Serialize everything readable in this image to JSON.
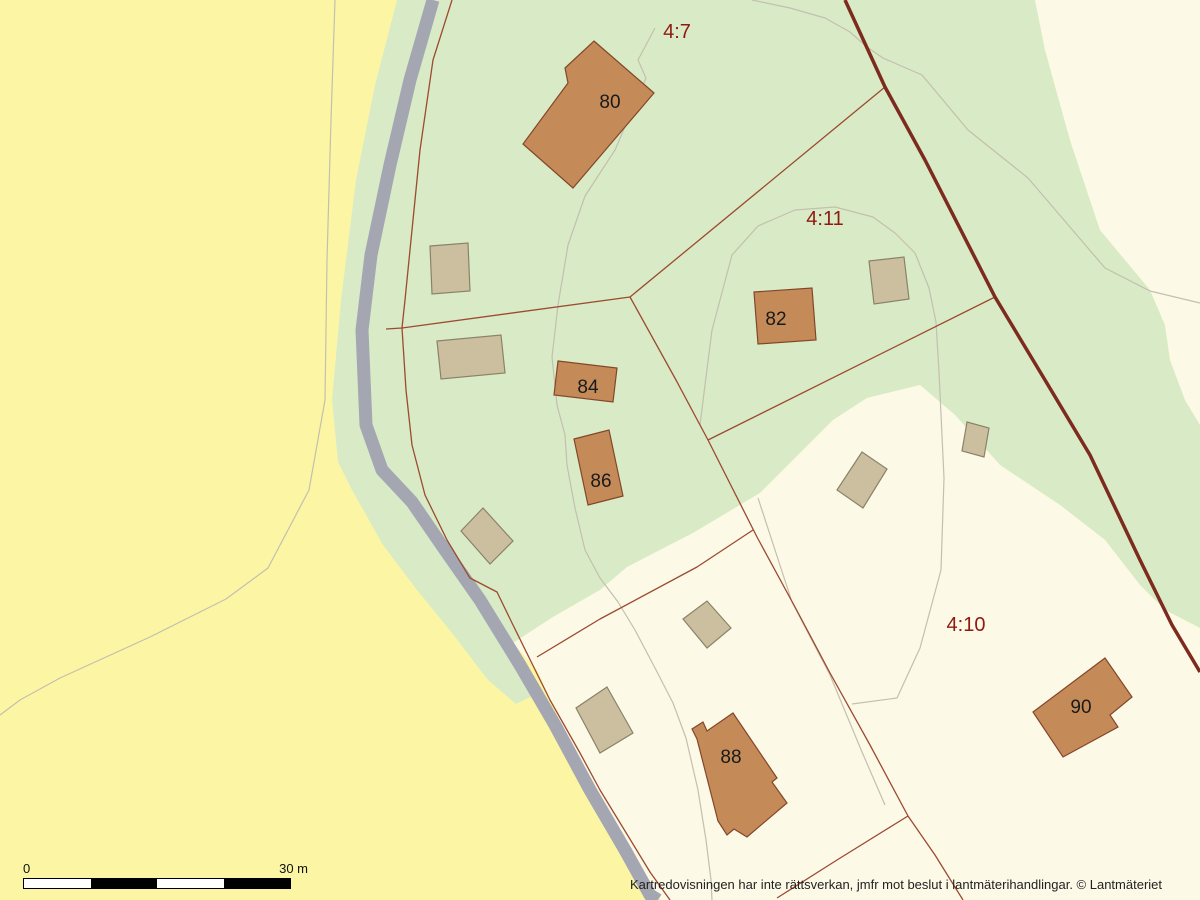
{
  "disclaimer": "Kartredovisningen har inte rättsverkan, jmfr mot beslut i lantmäterihandlingar. © Lantmäteriet",
  "scale_bar": {
    "start_label": "0",
    "end_label": "30 m",
    "segment_colors": [
      "#ffffff",
      "#000000",
      "#ffffff",
      "#000000"
    ]
  },
  "map": {
    "colors": {
      "field": "#FCF6A4",
      "forest": "#D8EBC6",
      "open_land": "#FCF9E7",
      "road": "#A4A6B2",
      "trail": "#C4BFAE",
      "boundary": "#9C4A30",
      "boundary_major": "#7D2B1E",
      "residential_fill": "#C48A58",
      "residential_stroke": "#84462A",
      "outbuilding_fill": "#CBBF9F",
      "outbuilding_stroke": "#8B8268",
      "parcel_label": "#8E1A10",
      "building_label": "#1A1A1A"
    },
    "land_areas": [
      {
        "name": "forest",
        "fill_key": "forest",
        "points": [
          [
            397,
            0
          ],
          [
            375,
            85
          ],
          [
            356,
            180
          ],
          [
            341,
            300
          ],
          [
            332,
            400
          ],
          [
            338,
            462
          ],
          [
            352,
            490
          ],
          [
            383,
            545
          ],
          [
            417,
            590
          ],
          [
            452,
            633
          ],
          [
            488,
            680
          ],
          [
            516,
            704
          ],
          [
            543,
            691
          ],
          [
            513,
            643
          ],
          [
            553,
            617
          ],
          [
            600,
            590
          ],
          [
            627,
            567
          ],
          [
            693,
            533
          ],
          [
            760,
            493
          ],
          [
            833,
            420
          ],
          [
            867,
            398
          ],
          [
            920,
            385
          ],
          [
            955,
            415
          ],
          [
            1000,
            465
          ],
          [
            1060,
            505
          ],
          [
            1105,
            540
          ],
          [
            1140,
            585
          ],
          [
            1165,
            610
          ],
          [
            1200,
            628
          ],
          [
            1200,
            425
          ],
          [
            1185,
            400
          ],
          [
            1170,
            360
          ],
          [
            1165,
            325
          ],
          [
            1150,
            290
          ],
          [
            1100,
            230
          ],
          [
            1070,
            140
          ],
          [
            1045,
            50
          ],
          [
            1035,
            0
          ]
        ]
      },
      {
        "name": "open-land-northeast",
        "fill_key": "open_land",
        "points": [
          [
            1035,
            0
          ],
          [
            1045,
            50
          ],
          [
            1070,
            140
          ],
          [
            1100,
            230
          ],
          [
            1150,
            290
          ],
          [
            1165,
            325
          ],
          [
            1170,
            360
          ],
          [
            1185,
            400
          ],
          [
            1200,
            425
          ],
          [
            1200,
            0
          ]
        ]
      },
      {
        "name": "open-land-south",
        "fill_key": "open_land",
        "points": [
          [
            513,
            643
          ],
          [
            537,
            670
          ],
          [
            562,
            725
          ],
          [
            597,
            790
          ],
          [
            632,
            850
          ],
          [
            657,
            895
          ],
          [
            662,
            900
          ],
          [
            1200,
            900
          ],
          [
            1200,
            628
          ],
          [
            1165,
            610
          ],
          [
            1140,
            585
          ],
          [
            1105,
            540
          ],
          [
            1060,
            505
          ],
          [
            1000,
            465
          ],
          [
            955,
            415
          ],
          [
            920,
            385
          ],
          [
            867,
            398
          ],
          [
            833,
            420
          ],
          [
            760,
            493
          ],
          [
            693,
            533
          ],
          [
            627,
            567
          ],
          [
            600,
            590
          ],
          [
            553,
            617
          ]
        ]
      }
    ],
    "trails": [
      {
        "points": [
          [
            335,
            0
          ],
          [
            331,
            120
          ],
          [
            327,
            260
          ],
          [
            325,
            400
          ],
          [
            309,
            490
          ],
          [
            268,
            568
          ],
          [
            226,
            599
          ],
          [
            150,
            637
          ],
          [
            60,
            678
          ],
          [
            20,
            700
          ],
          [
            0,
            715
          ]
        ]
      },
      {
        "points": [
          [
            655,
            28
          ],
          [
            638,
            60
          ],
          [
            646,
            78
          ],
          [
            615,
            150
          ],
          [
            585,
            196
          ],
          [
            568,
            245
          ],
          [
            558,
            305
          ],
          [
            552,
            357
          ],
          [
            557,
            405
          ],
          [
            565,
            435
          ],
          [
            567,
            465
          ],
          [
            575,
            508
          ],
          [
            585,
            550
          ],
          [
            600,
            578
          ],
          [
            618,
            602
          ],
          [
            635,
            630
          ],
          [
            655,
            668
          ],
          [
            673,
            703
          ],
          [
            686,
            738
          ],
          [
            698,
            790
          ],
          [
            706,
            840
          ],
          [
            711,
            880
          ],
          [
            712,
            900
          ]
        ]
      },
      {
        "points": [
          [
            700,
            425
          ],
          [
            705,
            385
          ],
          [
            712,
            330
          ],
          [
            732,
            255
          ],
          [
            758,
            226
          ],
          [
            795,
            210
          ],
          [
            835,
            207
          ],
          [
            873,
            217
          ],
          [
            895,
            233
          ],
          [
            915,
            253
          ],
          [
            929,
            288
          ],
          [
            936,
            322
          ],
          [
            939,
            372
          ],
          [
            944,
            478
          ],
          [
            941,
            570
          ],
          [
            920,
            648
          ],
          [
            897,
            698
          ],
          [
            852,
            704
          ]
        ]
      },
      {
        "points": [
          [
            752,
            0
          ],
          [
            790,
            8
          ],
          [
            825,
            18
          ],
          [
            850,
            32
          ],
          [
            867,
            47
          ],
          [
            883,
            58
          ],
          [
            922,
            75
          ],
          [
            968,
            130
          ],
          [
            1028,
            178
          ],
          [
            1105,
            268
          ],
          [
            1150,
            291
          ],
          [
            1200,
            303
          ]
        ]
      },
      {
        "points": [
          [
            758,
            498
          ],
          [
            792,
            602
          ],
          [
            830,
            675
          ],
          [
            862,
            752
          ],
          [
            885,
            805
          ]
        ]
      }
    ],
    "road": {
      "width": 13,
      "points": [
        [
          433,
          0
        ],
        [
          410,
          80
        ],
        [
          390,
          165
        ],
        [
          371,
          255
        ],
        [
          362,
          330
        ],
        [
          366,
          425
        ],
        [
          382,
          470
        ],
        [
          412,
          502
        ],
        [
          445,
          550
        ],
        [
          480,
          600
        ],
        [
          520,
          665
        ],
        [
          555,
          725
        ],
        [
          590,
          790
        ],
        [
          625,
          850
        ],
        [
          650,
          895
        ],
        [
          658,
          900
        ]
      ]
    },
    "boundaries": [
      {
        "points": [
          [
            452,
            0
          ],
          [
            433,
            60
          ],
          [
            420,
            150
          ],
          [
            412,
            230
          ],
          [
            405,
            300
          ],
          [
            402,
            328
          ],
          [
            406,
            390
          ],
          [
            412,
            445
          ],
          [
            425,
            495
          ],
          [
            447,
            540
          ],
          [
            470,
            578
          ],
          [
            497,
            592
          ],
          [
            513,
            625
          ],
          [
            550,
            700
          ],
          [
            580,
            753
          ],
          [
            600,
            790
          ],
          [
            650,
            872
          ],
          [
            670,
            900
          ]
        ]
      },
      {
        "points": [
          [
            386,
            329
          ],
          [
            402,
            328
          ],
          [
            630,
            297
          ]
        ]
      },
      {
        "points": [
          [
            630,
            297
          ],
          [
            885,
            87
          ]
        ]
      },
      {
        "points": [
          [
            630,
            297
          ],
          [
            676,
            380
          ],
          [
            708,
            440
          ]
        ]
      },
      {
        "points": [
          [
            708,
            440
          ],
          [
            995,
            297
          ]
        ]
      },
      {
        "points": [
          [
            708,
            440
          ],
          [
            757,
            537
          ],
          [
            795,
            607
          ],
          [
            830,
            673
          ],
          [
            870,
            745
          ],
          [
            908,
            816
          ]
        ]
      },
      {
        "points": [
          [
            753,
            530
          ],
          [
            697,
            567
          ],
          [
            600,
            619
          ],
          [
            537,
            657
          ]
        ]
      },
      {
        "points": [
          [
            908,
            816
          ],
          [
            935,
            855
          ],
          [
            963,
            900
          ]
        ]
      },
      {
        "points": [
          [
            908,
            816
          ],
          [
            837,
            860
          ],
          [
            777,
            898
          ]
        ]
      }
    ],
    "major_boundary": {
      "width": 3.5,
      "points": [
        [
          845,
          0
        ],
        [
          885,
          87
        ],
        [
          925,
          160
        ],
        [
          995,
          297
        ],
        [
          1045,
          380
        ],
        [
          1090,
          455
        ],
        [
          1140,
          560
        ],
        [
          1172,
          625
        ],
        [
          1200,
          672
        ]
      ]
    },
    "buildings": [
      {
        "label": "80",
        "type": "residential",
        "points": [
          [
            594,
            41
          ],
          [
            654,
            93
          ],
          [
            573,
            188
          ],
          [
            523,
            144
          ],
          [
            568,
            83
          ],
          [
            565,
            68
          ]
        ],
        "lx": 610,
        "ly": 108
      },
      {
        "label": "82",
        "type": "residential",
        "points": [
          [
            754,
            292
          ],
          [
            812,
            288
          ],
          [
            816,
            340
          ],
          [
            758,
            344
          ]
        ],
        "lx": 776,
        "ly": 325
      },
      {
        "label": "84",
        "type": "residential",
        "points": [
          [
            558,
            361
          ],
          [
            617,
            368
          ],
          [
            613,
            402
          ],
          [
            554,
            395
          ]
        ],
        "lx": 588,
        "ly": 393
      },
      {
        "label": "86",
        "type": "residential",
        "points": [
          [
            574,
            439
          ],
          [
            609,
            430
          ],
          [
            623,
            496
          ],
          [
            588,
            505
          ]
        ],
        "lx": 601,
        "ly": 487
      },
      {
        "label": "88",
        "type": "residential",
        "points": [
          [
            733,
            713
          ],
          [
            777,
            778
          ],
          [
            772,
            782
          ],
          [
            787,
            803
          ],
          [
            747,
            837
          ],
          [
            734,
            829
          ],
          [
            727,
            835
          ],
          [
            718,
            821
          ],
          [
            697,
            739
          ],
          [
            692,
            729
          ],
          [
            703,
            722
          ],
          [
            707,
            731
          ]
        ],
        "lx": 731,
        "ly": 763
      },
      {
        "label": "90",
        "type": "residential",
        "points": [
          [
            1105,
            658
          ],
          [
            1132,
            697
          ],
          [
            1110,
            715
          ],
          [
            1118,
            727
          ],
          [
            1063,
            757
          ],
          [
            1033,
            712
          ]
        ],
        "lx": 1081,
        "ly": 713
      },
      {
        "type": "outbuilding",
        "points": [
          [
            430,
            246
          ],
          [
            468,
            243
          ],
          [
            470,
            291
          ],
          [
            432,
            294
          ]
        ]
      },
      {
        "type": "outbuilding",
        "points": [
          [
            437,
            341
          ],
          [
            501,
            335
          ],
          [
            505,
            373
          ],
          [
            441,
            379
          ]
        ]
      },
      {
        "type": "outbuilding",
        "points": [
          [
            483,
            508
          ],
          [
            513,
            541
          ],
          [
            490,
            564
          ],
          [
            461,
            531
          ]
        ]
      },
      {
        "type": "outbuilding",
        "points": [
          [
            869,
            261
          ],
          [
            904,
            257
          ],
          [
            909,
            299
          ],
          [
            874,
            304
          ]
        ]
      },
      {
        "type": "outbuilding",
        "points": [
          [
            862,
            452
          ],
          [
            887,
            469
          ],
          [
            863,
            508
          ],
          [
            837,
            490
          ]
        ]
      },
      {
        "type": "outbuilding",
        "points": [
          [
            967,
            422
          ],
          [
            989,
            428
          ],
          [
            984,
            457
          ],
          [
            962,
            451
          ]
        ]
      },
      {
        "type": "outbuilding",
        "points": [
          [
            707,
            601
          ],
          [
            731,
            628
          ],
          [
            707,
            648
          ],
          [
            683,
            619
          ]
        ]
      },
      {
        "type": "outbuilding",
        "points": [
          [
            607,
            687
          ],
          [
            633,
            733
          ],
          [
            600,
            753
          ],
          [
            576,
            708
          ]
        ]
      }
    ],
    "parcel_labels": [
      {
        "text": "4:7",
        "x": 677,
        "y": 38
      },
      {
        "text": "4:11",
        "x": 825,
        "y": 225
      },
      {
        "text": "4:10",
        "x": 966,
        "y": 631
      }
    ]
  }
}
